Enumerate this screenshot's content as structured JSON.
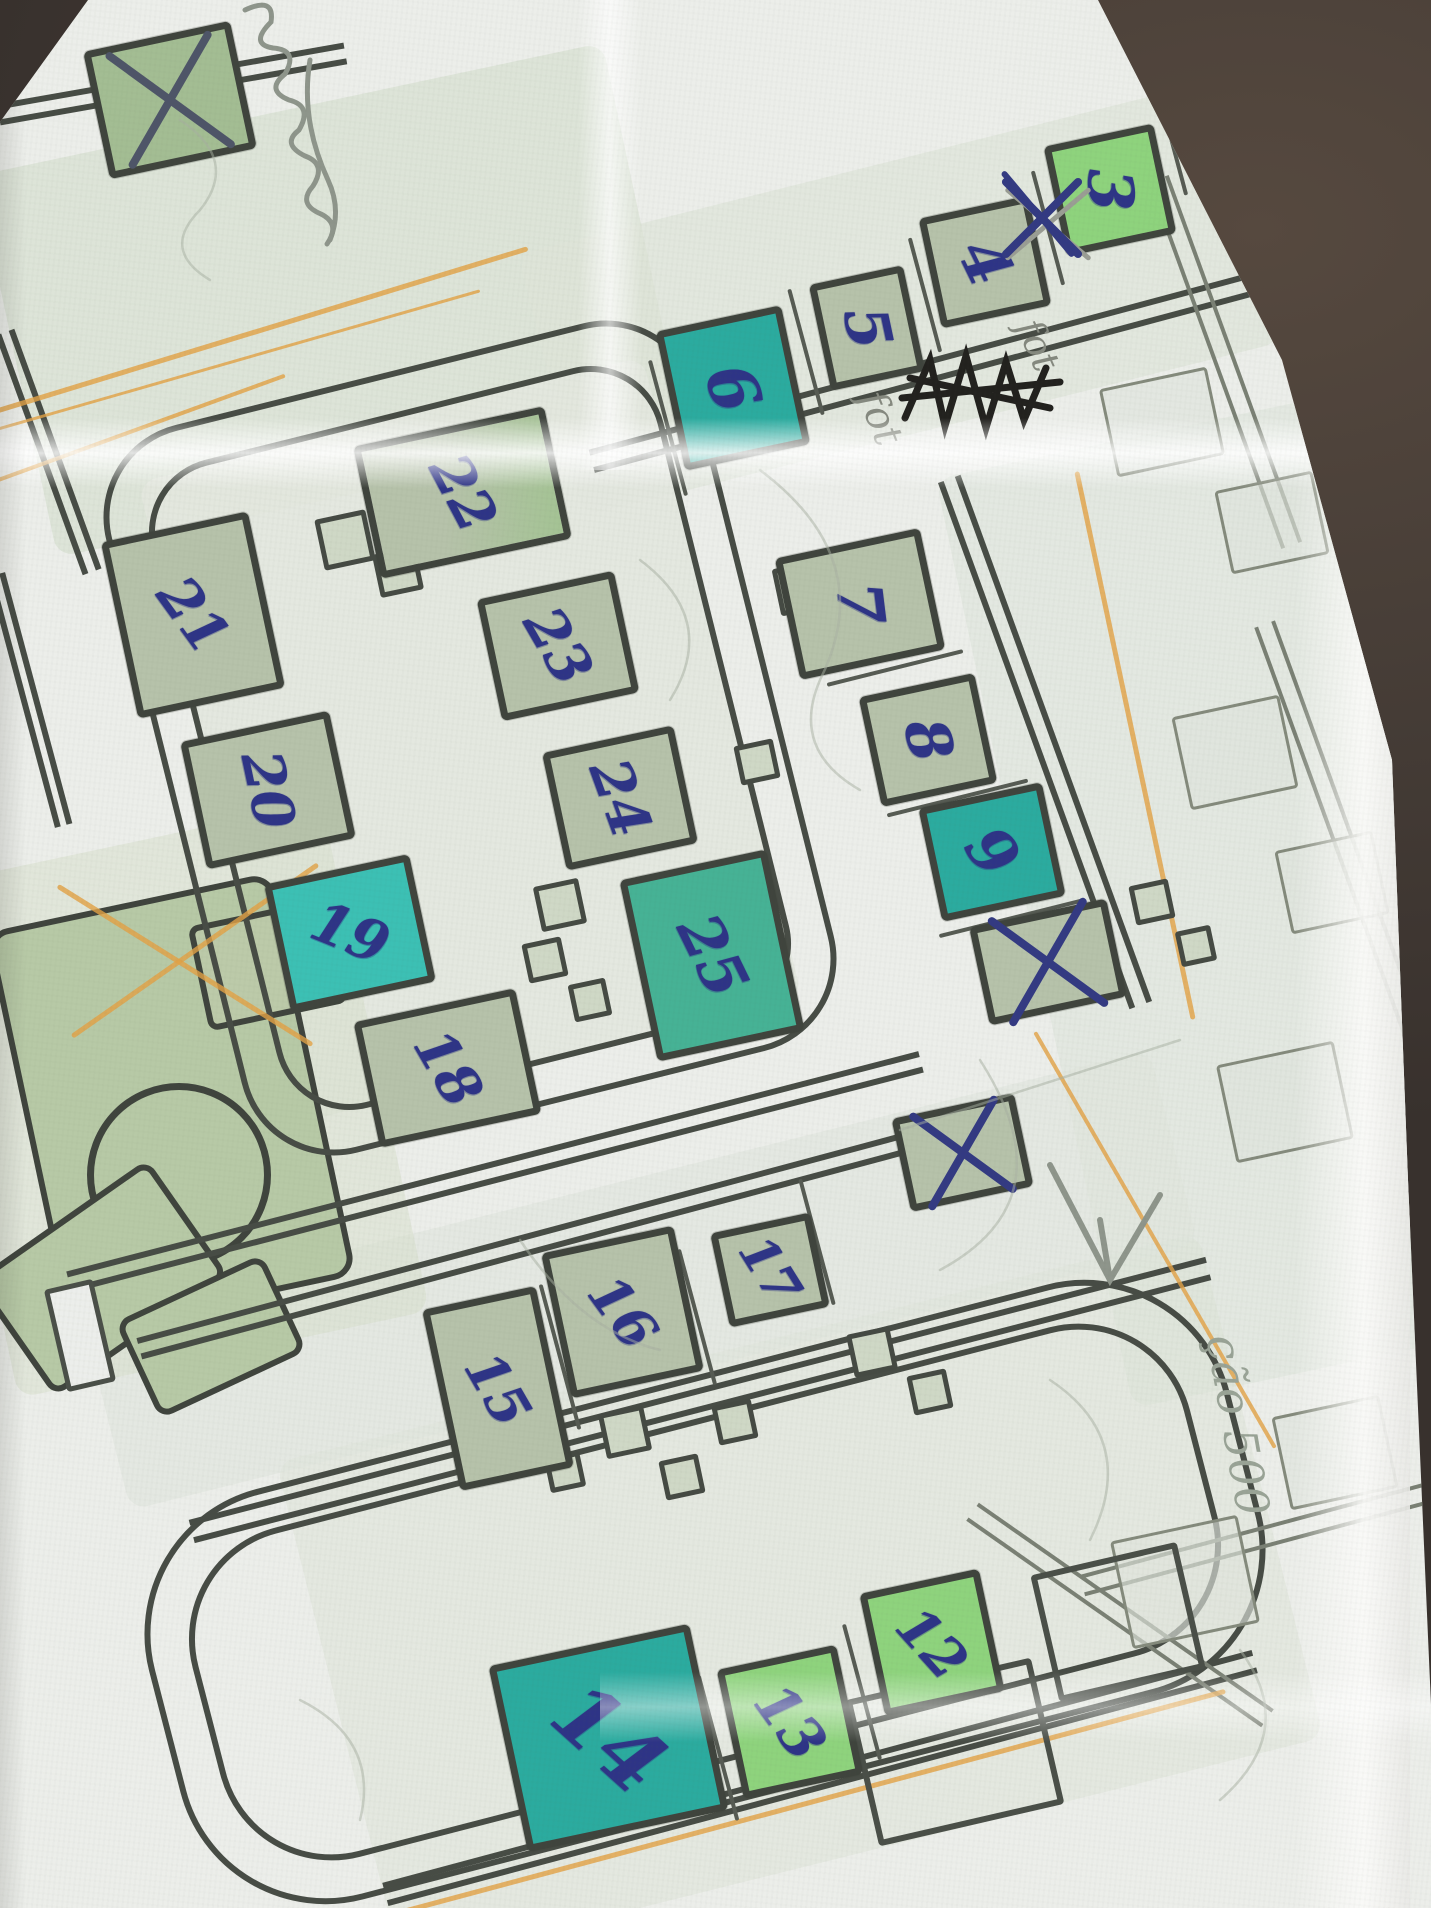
{
  "scene": {
    "description": "photograph of a folded paper street map annotated by hand",
    "background_color": "#453c36",
    "paper_color": "#eceeea",
    "map_ink_color": "#474c45",
    "building_outline_color": "#3f443d",
    "pen_blue": "#2e3486",
    "pencil_gray": "#888d82",
    "orange_road_color": "#e2a145",
    "fill_colors": {
      "sage": "#b6c2aa",
      "sage2": "#a3bd93",
      "sageG": "#a4c394",
      "bright": "#8ed37d",
      "teal": "#2bab9f",
      "tealB": "#3cc0b4",
      "tealG": "#46b295"
    }
  },
  "map": {
    "visible_building_numbers": [
      "3",
      "4",
      "5",
      "6",
      "7",
      "8",
      "9",
      "12",
      "13",
      "14",
      "15",
      "16",
      "17",
      "18",
      "19",
      "20",
      "21",
      "22",
      "23",
      "24",
      "25"
    ],
    "highlighted_teal_numbers": [
      "6",
      "9",
      "14",
      "19",
      "25"
    ],
    "crossed_out_buildings": 3,
    "washes": [
      {
        "x": 330,
        "y": 300,
        "w": 640,
        "h": 390,
        "rot": -12,
        "c": "#d9e1d3",
        "o": 0.8
      },
      {
        "x": 900,
        "y": 298,
        "w": 720,
        "h": 270,
        "rot": -14,
        "c": "#dee4d8",
        "o": 0.7
      },
      {
        "x": 1240,
        "y": 900,
        "w": 420,
        "h": 950,
        "rot": -12,
        "c": "#dde3d8",
        "o": 0.55
      },
      {
        "x": 800,
        "y": 1600,
        "w": 950,
        "h": 520,
        "rot": -14,
        "c": "#dce2d6",
        "o": 0.5
      },
      {
        "x": 470,
        "y": 740,
        "w": 520,
        "h": 660,
        "rot": -14,
        "c": "#e3e7df",
        "o": 0.9
      },
      {
        "x": 640,
        "y": 1280,
        "w": 1100,
        "h": 200,
        "rot": -14,
        "c": "#e0e5dc",
        "o": 0.6
      },
      {
        "x": 170,
        "y": 1100,
        "w": 420,
        "h": 520,
        "rot": -12,
        "c": "#d5ddc9",
        "o": 0.5
      }
    ],
    "parks": {
      "blob": {
        "x": 165,
        "y": 1098,
        "w": 280,
        "h": 400,
        "rot": -12,
        "c": "#b7c9a6"
      },
      "circle": {
        "x": 172,
        "y": 1168,
        "d": 170,
        "c": "#b7c9a6"
      },
      "append": {
        "x": 95,
        "y": 1272,
        "w": 200,
        "h": 130,
        "rot": -35,
        "c": "#b7c9a6"
      },
      "wedge": {
        "x": 262,
        "y": 958,
        "w": 130,
        "h": 95,
        "rot": -12,
        "c": "#bccaa9"
      },
      "tail": {
        "x": 205,
        "y": 1330,
        "w": 150,
        "h": 95,
        "rot": -25,
        "c": "#b7c9a6"
      }
    },
    "loops": [
      {
        "x": 470,
        "y": 738,
        "w": 610,
        "h": 750,
        "rot": -14,
        "rad": 95,
        "b": 6
      },
      {
        "x": 470,
        "y": 738,
        "w": 528,
        "h": 668,
        "rot": -14,
        "rad": 75,
        "b": 6
      },
      {
        "x": 705,
        "y": 1592,
        "w": 1030,
        "h": 340,
        "rot": -14.5,
        "rad": 115,
        "b": 6
      },
      {
        "x": 705,
        "y": 1592,
        "w": 1116,
        "h": 424,
        "rot": -14.5,
        "rad": 150,
        "b": 6
      }
    ],
    "roads": [
      {
        "x": 172,
        "y": 84,
        "len": 352,
        "gap": 22,
        "rot": -10
      },
      {
        "x": 925,
        "y": 372,
        "len": 690,
        "gap": 24,
        "rot": -15
      },
      {
        "x": 1045,
        "y": 742,
        "len": 560,
        "gap": 24,
        "rot": 70
      },
      {
        "x": 495,
        "y": 1172,
        "len": 880,
        "gap": 22,
        "rot": -14.5
      },
      {
        "x": 545,
        "y": 1240,
        "len": 840,
        "gap": 22,
        "rot": -15
      },
      {
        "x": 700,
        "y": 1400,
        "len": 1050,
        "gap": 24,
        "rot": -14.5
      },
      {
        "x": 820,
        "y": 1778,
        "len": 900,
        "gap": 24,
        "rot": -15
      },
      {
        "x": 48,
        "y": 452,
        "len": 255,
        "gap": 20,
        "rot": 70
      },
      {
        "x": 30,
        "y": 700,
        "len": 260,
        "gap": 18,
        "rot": 75
      },
      {
        "x": 1225,
        "y": 362,
        "len": 390,
        "gap": 22,
        "rot": 70,
        "faded": true
      },
      {
        "x": 1345,
        "y": 845,
        "len": 470,
        "gap": 22,
        "rot": 70,
        "faded": true
      },
      {
        "x": 1290,
        "y": 1530,
        "len": 430,
        "gap": 22,
        "rot": -15,
        "faded": true
      },
      {
        "x": 1120,
        "y": 1615,
        "len": 360,
        "gap": 22,
        "rot": 35,
        "faded": true
      }
    ],
    "orange_lines": [
      {
        "x": 260,
        "y": 330,
        "len": 560,
        "rot": -17,
        "w": 5
      },
      {
        "x": 230,
        "y": 362,
        "len": 520,
        "rot": -16,
        "w": 3
      },
      {
        "x": 130,
        "y": 432,
        "len": 330,
        "rot": -20,
        "w": 4
      },
      {
        "x": 195,
        "y": 950,
        "len": 300,
        "rot": -35,
        "w": 5
      },
      {
        "x": 185,
        "y": 965,
        "len": 300,
        "rot": 32,
        "w": 5
      },
      {
        "x": 1135,
        "y": 745,
        "len": 560,
        "rot": 78,
        "w": 5
      },
      {
        "x": 1155,
        "y": 1240,
        "len": 480,
        "rot": 60,
        "w": 4
      },
      {
        "x": 810,
        "y": 1802,
        "len": 860,
        "rot": -15,
        "w": 5
      },
      {
        "x": 1300,
        "y": 150,
        "len": 300,
        "rot": 75,
        "w": 4
      }
    ],
    "dividers": [
      {
        "x": 1048,
        "y": 228,
        "len": 118,
        "rot": 75
      },
      {
        "x": 925,
        "y": 295,
        "len": 118,
        "rot": 75
      },
      {
        "x": 806,
        "y": 352,
        "len": 130,
        "rot": 75
      },
      {
        "x": 668,
        "y": 428,
        "len": 140,
        "rot": 75
      },
      {
        "x": 1172,
        "y": 142,
        "len": 110,
        "rot": 75
      },
      {
        "x": 895,
        "y": 668,
        "len": 140,
        "rot": -14
      },
      {
        "x": 957,
        "y": 798,
        "len": 145,
        "rot": -14
      },
      {
        "x": 1012,
        "y": 918,
        "len": 150,
        "rot": -14
      },
      {
        "x": 560,
        "y": 1357,
        "len": 150,
        "rot": 75
      },
      {
        "x": 697,
        "y": 1317,
        "len": 140,
        "rot": 75
      },
      {
        "x": 817,
        "y": 1242,
        "len": 130,
        "rot": 75
      },
      {
        "x": 862,
        "y": 1692,
        "len": 140,
        "rot": 75
      },
      {
        "x": 718,
        "y": 1748,
        "len": 150,
        "rot": 75
      }
    ],
    "connectors": [
      {
        "x": 345,
        "y": 540,
        "s": 52
      },
      {
        "x": 398,
        "y": 572,
        "s": 44
      },
      {
        "x": 800,
        "y": 588,
        "s": 48
      },
      {
        "x": 852,
        "y": 622,
        "s": 42
      },
      {
        "x": 560,
        "y": 905,
        "s": 46
      },
      {
        "x": 545,
        "y": 960,
        "s": 40
      },
      {
        "x": 590,
        "y": 1000,
        "s": 38
      },
      {
        "x": 757,
        "y": 762,
        "s": 40
      },
      {
        "x": 625,
        "y": 1432,
        "s": 46
      },
      {
        "x": 682,
        "y": 1477,
        "s": 40
      },
      {
        "x": 735,
        "y": 1422,
        "s": 40
      },
      {
        "x": 565,
        "y": 1472,
        "s": 36
      },
      {
        "x": 872,
        "y": 1352,
        "s": 44
      },
      {
        "x": 930,
        "y": 1392,
        "s": 40
      },
      {
        "x": 1152,
        "y": 902,
        "s": 40
      },
      {
        "x": 1196,
        "y": 946,
        "s": 36
      }
    ],
    "faded_lots": [
      {
        "x": 1162,
        "y": 422,
        "w": 110,
        "h": 90
      },
      {
        "x": 1272,
        "y": 522,
        "w": 100,
        "h": 85
      },
      {
        "x": 1235,
        "y": 752,
        "w": 110,
        "h": 95
      },
      {
        "x": 1332,
        "y": 882,
        "w": 100,
        "h": 85
      },
      {
        "x": 1285,
        "y": 1102,
        "w": 120,
        "h": 100
      },
      {
        "x": 1335,
        "y": 1452,
        "w": 110,
        "h": 95
      },
      {
        "x": 1185,
        "y": 1582,
        "w": 130,
        "h": 110
      }
    ],
    "outline_buildings": [
      {
        "x": 955,
        "y": 1752,
        "w": 190,
        "h": 150
      },
      {
        "x": 1118,
        "y": 1622,
        "w": 150,
        "h": 130
      },
      {
        "x": 80,
        "y": 1335,
        "w": 50,
        "h": 105,
        "fill": "#eceeeb"
      }
    ],
    "buildings": [
      {
        "x": 170,
        "y": 100,
        "w": 150,
        "h": 130,
        "fill": "sage2",
        "cross": "pencil"
      },
      {
        "n": "3",
        "x": 1110,
        "y": 190,
        "w": 112,
        "h": 112,
        "fill": "bright",
        "lr": 100,
        "fs": 62
      },
      {
        "n": "4",
        "x": 985,
        "y": 262,
        "w": 112,
        "h": 112,
        "fill": "sage",
        "lr": 76,
        "fs": 62
      },
      {
        "n": "5",
        "x": 867,
        "y": 328,
        "w": 96,
        "h": 108,
        "fill": "sage",
        "lr": 90,
        "fs": 60
      },
      {
        "n": "6",
        "x": 733,
        "y": 388,
        "w": 128,
        "h": 142,
        "fill": "teal",
        "lr": 82,
        "fs": 66
      },
      {
        "n": "7",
        "x": 860,
        "y": 604,
        "w": 148,
        "h": 124,
        "fill": "sage",
        "lr": 95,
        "fs": 62
      },
      {
        "n": "8",
        "x": 928,
        "y": 740,
        "w": 118,
        "h": 112,
        "fill": "sage",
        "lr": 88,
        "fs": 60
      },
      {
        "n": "9",
        "x": 992,
        "y": 852,
        "w": 126,
        "h": 116,
        "fill": "teal",
        "lr": 66,
        "fs": 62
      },
      {
        "x": 1048,
        "y": 962,
        "w": 140,
        "h": 100,
        "fill": "sage",
        "cross": "blue"
      },
      {
        "x": 962,
        "y": 1152,
        "w": 125,
        "h": 95,
        "fill": "sage",
        "cross": "blue"
      },
      {
        "n": "12",
        "x": 932,
        "y": 1642,
        "w": 122,
        "h": 125,
        "fill": "bright",
        "lr": 60,
        "fs": 54
      },
      {
        "n": "13",
        "x": 790,
        "y": 1722,
        "w": 122,
        "h": 132,
        "fill": "bright",
        "lr": 66,
        "fs": 56
      },
      {
        "n": "14",
        "x": 608,
        "y": 1738,
        "w": 205,
        "h": 190,
        "fill": "teal",
        "lr": 54,
        "fs": 84
      },
      {
        "n": "15",
        "x": 498,
        "y": 1388,
        "w": 116,
        "h": 185,
        "fill": "sage",
        "lr": 72,
        "fs": 54
      },
      {
        "n": "16",
        "x": 622,
        "y": 1312,
        "w": 135,
        "h": 148,
        "fill": "sage",
        "lr": 66,
        "fs": 54
      },
      {
        "n": "17",
        "x": 770,
        "y": 1270,
        "w": 102,
        "h": 96,
        "fill": "sage",
        "lr": 70,
        "fs": 50
      },
      {
        "n": "18",
        "x": 447,
        "y": 1068,
        "w": 165,
        "h": 128,
        "fill": "sage",
        "lr": 72,
        "fs": 56
      },
      {
        "n": "19",
        "x": 350,
        "y": 933,
        "w": 148,
        "h": 130,
        "fill": "tealB",
        "lr": 34,
        "fs": 56
      },
      {
        "n": "20",
        "x": 268,
        "y": 790,
        "w": 152,
        "h": 130,
        "fill": "sage",
        "lr": 90,
        "fs": 56
      },
      {
        "n": "21",
        "x": 193,
        "y": 615,
        "w": 150,
        "h": 180,
        "fill": "sage",
        "lr": 66,
        "fs": 56
      },
      {
        "n": "22",
        "x": 462,
        "y": 492,
        "w": 195,
        "h": 135,
        "fill": "sageG",
        "lr": 74,
        "fs": 56
      },
      {
        "n": "23",
        "x": 558,
        "y": 646,
        "w": 140,
        "h": 124,
        "fill": "sage",
        "lr": 72,
        "fs": 56
      },
      {
        "n": "24",
        "x": 620,
        "y": 798,
        "w": 134,
        "h": 120,
        "fill": "sage",
        "lr": 82,
        "fs": 56
      },
      {
        "n": "25",
        "x": 712,
        "y": 955,
        "w": 150,
        "h": 185,
        "fill": "tealG",
        "lr": 76,
        "fs": 60
      }
    ]
  },
  "annotations": {
    "handwritten_texts": [
      {
        "text": "fot",
        "x": 880,
        "y": 418,
        "rot": 68,
        "fs": 40,
        "c": "#85897f"
      },
      {
        "text": "fot",
        "x": 1038,
        "y": 345,
        "rot": 66,
        "fs": 38,
        "c": "#85897f"
      },
      {
        "text": "ção 500",
        "x": 1238,
        "y": 1425,
        "rot": 80,
        "fs": 46,
        "c": "#99a396"
      }
    ],
    "x_scribbles": [
      {
        "x": 1042,
        "y": 218,
        "s": 110,
        "c": "#333a82",
        "pencil_under": true
      }
    ],
    "notes": {
      "black_scribble": "heavy black ink scribble (crossed-out word)",
      "top_left_cursive": "illegible pencil cursive handwriting",
      "pencil_arrow": "pencil check/arrow mark"
    }
  }
}
